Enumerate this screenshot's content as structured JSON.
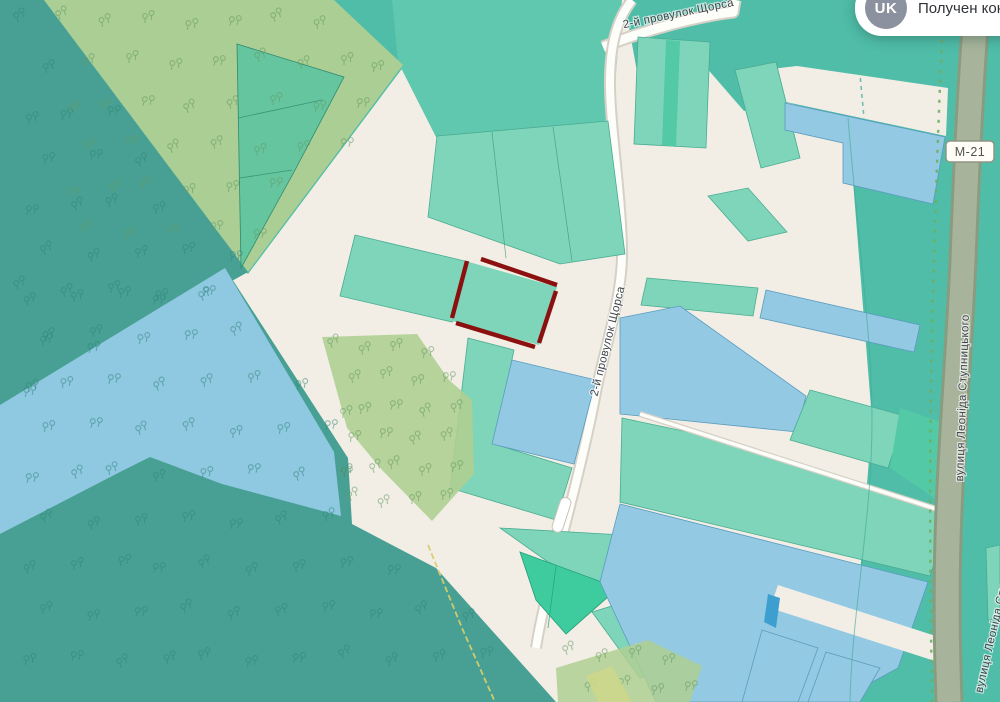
{
  "toast": {
    "avatar_initials": "UK",
    "message": "Получен кон"
  },
  "map_labels": {
    "street_top": "2-й провулок Щорса",
    "street_side": "2-й провулок Щорса",
    "street_right": "вулиця Леоніда Ступницького",
    "street_right_lower": "вулиця Леоніда Ступницького",
    "highway_badge": "М-21"
  },
  "colors": {
    "beige": "#f2eee5",
    "teal_bg": "#4fbda8",
    "teal_block": "#5fc8af",
    "dark_forest": "#47a093",
    "olive": "#afcf92",
    "water": "#8fc8e1",
    "parcel": "#7ed5b9",
    "parcel_stroke": "#49ac92",
    "parcel_blue": "#94c9e3",
    "parcel_blue_stroke": "#5a9cbf",
    "parcel_blue_dark": "#3d9fd0",
    "wedge": "#52c3a0",
    "emerald": "#3ecb9e",
    "teal_strip": "#53c9a6",
    "lime": "#ccd789",
    "road_white": "#fdfdfa",
    "road_casing": "#d6d1c6",
    "highway_fill": "#a7b49b",
    "highway_edge": "#8a9c80",
    "path_green": "#6fae5e",
    "boundary_yellow": "#d6ce6b",
    "selected_outline": "#8b1111",
    "tree_dark": "#2f8478",
    "tree_olive": "#669b66",
    "label": "#41464b",
    "badge_bg": "#fffdf5",
    "badge_border": "#8f9383"
  }
}
